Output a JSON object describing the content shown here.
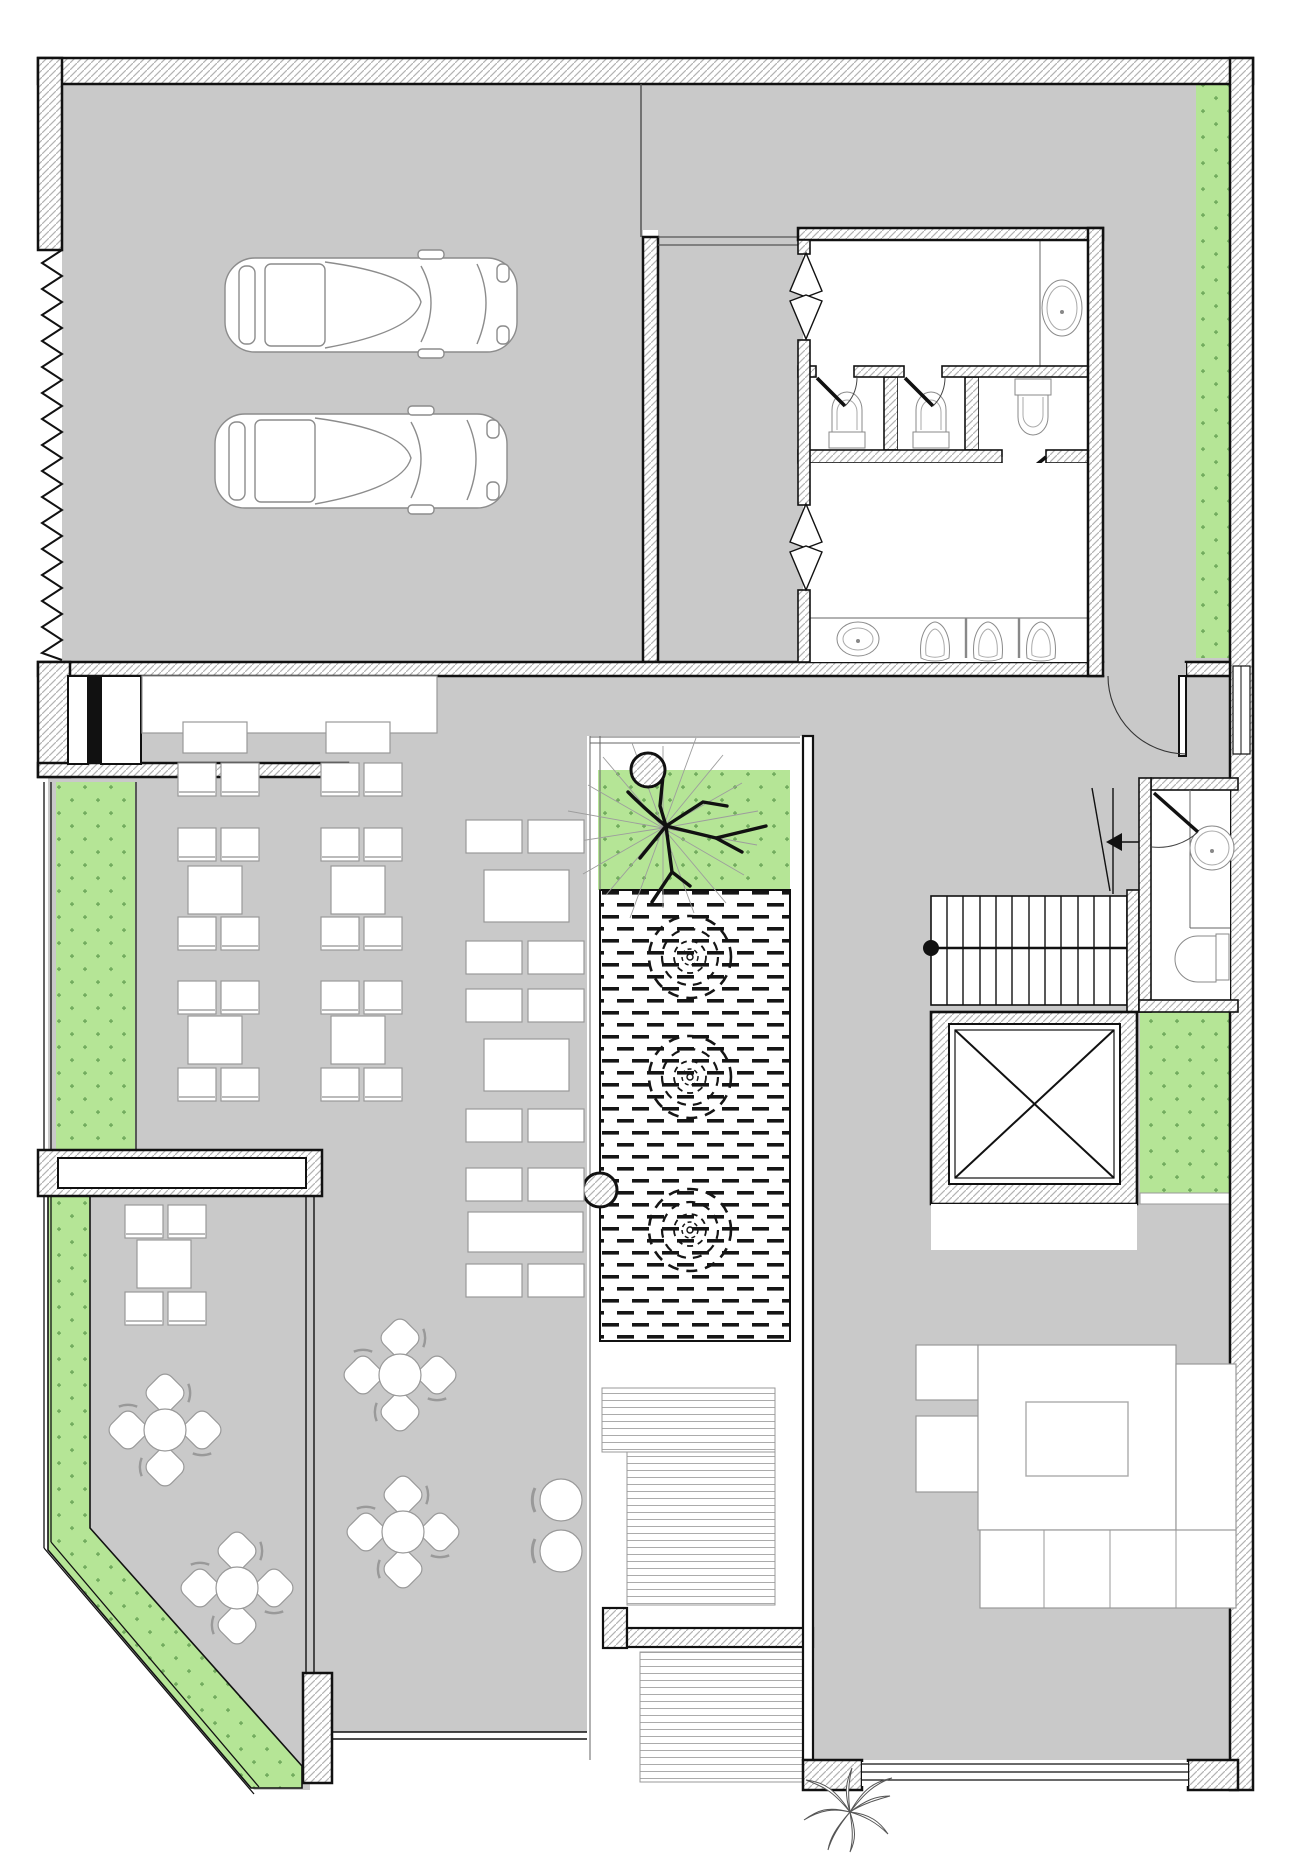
{
  "document": {
    "type": "architectural-floor-plan",
    "view": "ground-floor top view",
    "visible_text": []
  },
  "colors": {
    "background": "#ffffff",
    "floor": "#c9c9c9",
    "planting": "#b5e596",
    "planting_dot": "#6ca659",
    "wall_line": "#111111",
    "wall_hatch": "#b3b3b3",
    "deck_line": "#ababab",
    "furniture_line": "#999999",
    "water_dash": "#151515",
    "thin_line": "#666666"
  },
  "inventory": {
    "garage": {
      "cars": 2,
      "roller_door_zigzag": 1
    },
    "restrooms": {
      "wc_stalls": 2,
      "wc_rooms": 1,
      "urinals": 3,
      "washbasins": 2,
      "swing_door_symbols": 2
    },
    "powder_room": {
      "washbasins": 1,
      "toilets": 1
    },
    "atrium": {
      "trees": 1,
      "fountain_jets": 3,
      "round_columns": 2,
      "reflecting_pool": 1
    },
    "dining": {
      "chair_pairs": 12,
      "square_tables": 5,
      "head_tables": 2,
      "banquette_benches": 12,
      "banquette_tables": 3,
      "round_tables": 4,
      "round_table_chairs": 16,
      "stools": 2,
      "service_counter": 1,
      "low_divider_wall": 1
    },
    "living_room": {
      "sofa_sections": 7,
      "coffee_tables": 1,
      "window_bays": 1,
      "outdoor_plants": 1
    },
    "circulation": {
      "stair_flights": 1,
      "elevators": 1,
      "entrance_doors": 1,
      "deck_step_areas": 3
    },
    "planting_strips": 5
  }
}
